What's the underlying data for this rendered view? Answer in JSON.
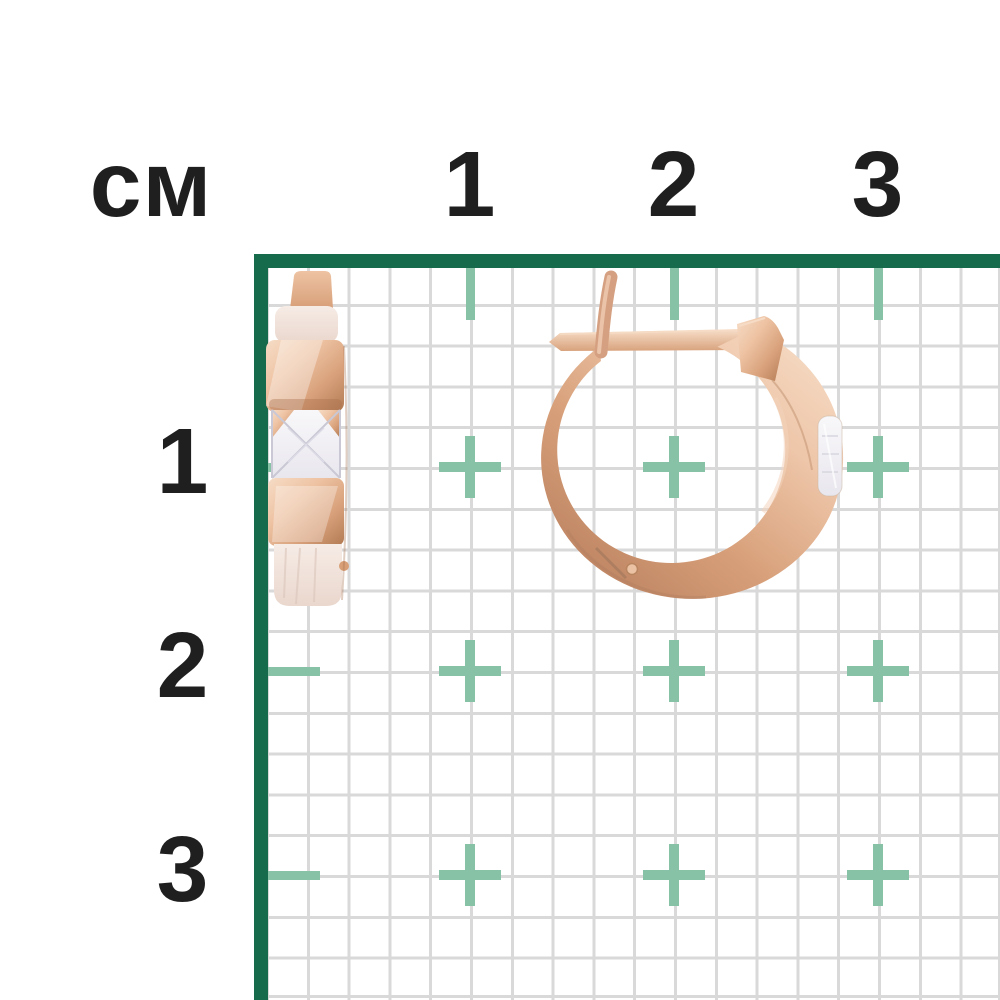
{
  "ruler": {
    "unit_label": "см",
    "top_labels": [
      "1",
      "2",
      "3"
    ],
    "left_labels": [
      "1",
      "2",
      "3"
    ]
  },
  "colors": {
    "axis_green": "#166b4c",
    "tick_teal": "#87c2a7",
    "grid_line": "#d9d9d9",
    "text_dark": "#1f1f1f",
    "gold_highlight": "#f6dcc6",
    "gold_light": "#eec3a3",
    "gold_mid": "#d79f79",
    "gold_deep": "#b17a52",
    "hoop_light": "#eec6a9",
    "hoop_deep": "#bb8160",
    "frost_light": "#f6ece6",
    "frost_deep": "#ead7cd",
    "stone_light": "#f8f7f9",
    "stone_deep": "#e9e7ee"
  },
  "product": {
    "items": [
      {
        "name": "earring-side-view"
      },
      {
        "name": "earring-front-view"
      }
    ]
  }
}
